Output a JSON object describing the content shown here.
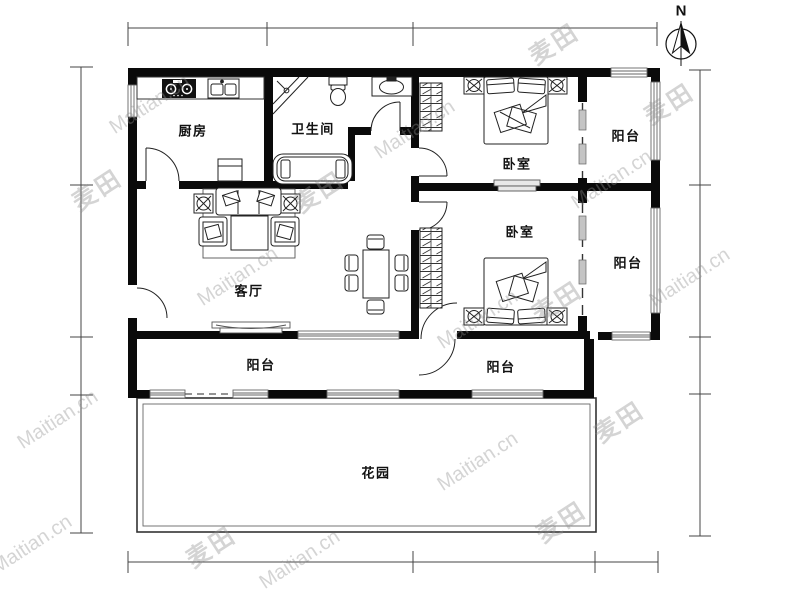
{
  "compass": {
    "label": "N"
  },
  "rooms": {
    "kitchen": "厨房",
    "bathroom": "卫生间",
    "living": "客厅",
    "bedroom_north": "卧室",
    "bedroom_south": "卧室",
    "balcony_northeast": "阳台",
    "balcony_east": "阳台",
    "balcony_south_left": "阳台",
    "balcony_south_right": "阳台",
    "garden": "花园"
  },
  "watermark": {
    "brand": "Maitian.cn",
    "logo": "麦田"
  }
}
